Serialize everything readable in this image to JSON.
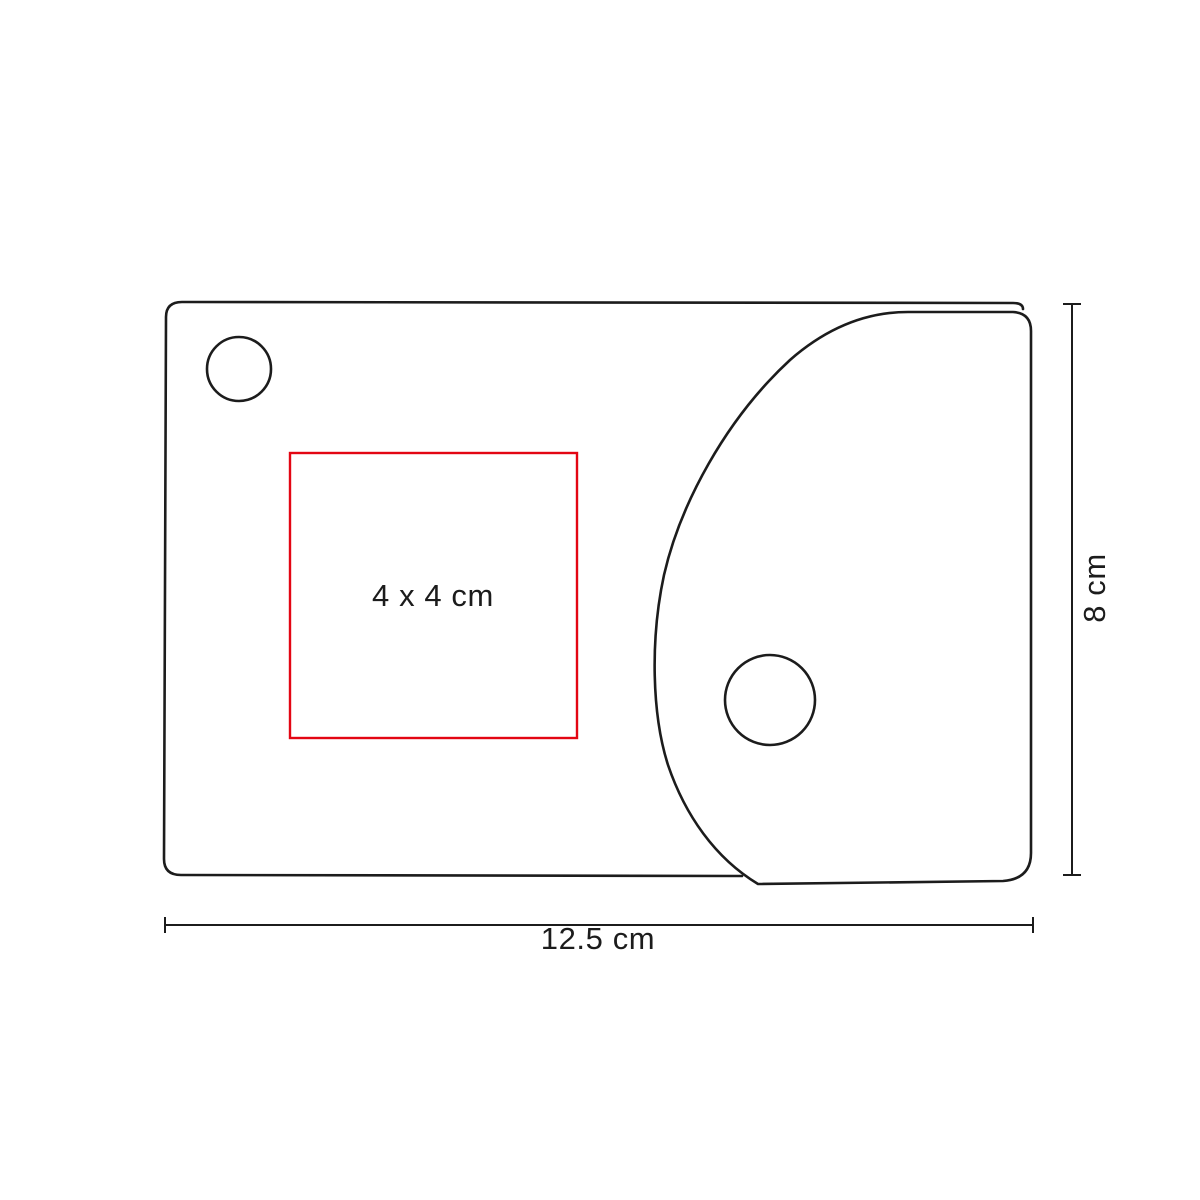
{
  "diagram": {
    "labels": {
      "print_area": "4 x 4 cm",
      "width": "12.5 cm",
      "height": "8 cm"
    },
    "colors": {
      "outline": "#1c1c1c",
      "print_area_box": "#e30613",
      "text": "#1c1c1c",
      "background": "#ffffff"
    }
  }
}
